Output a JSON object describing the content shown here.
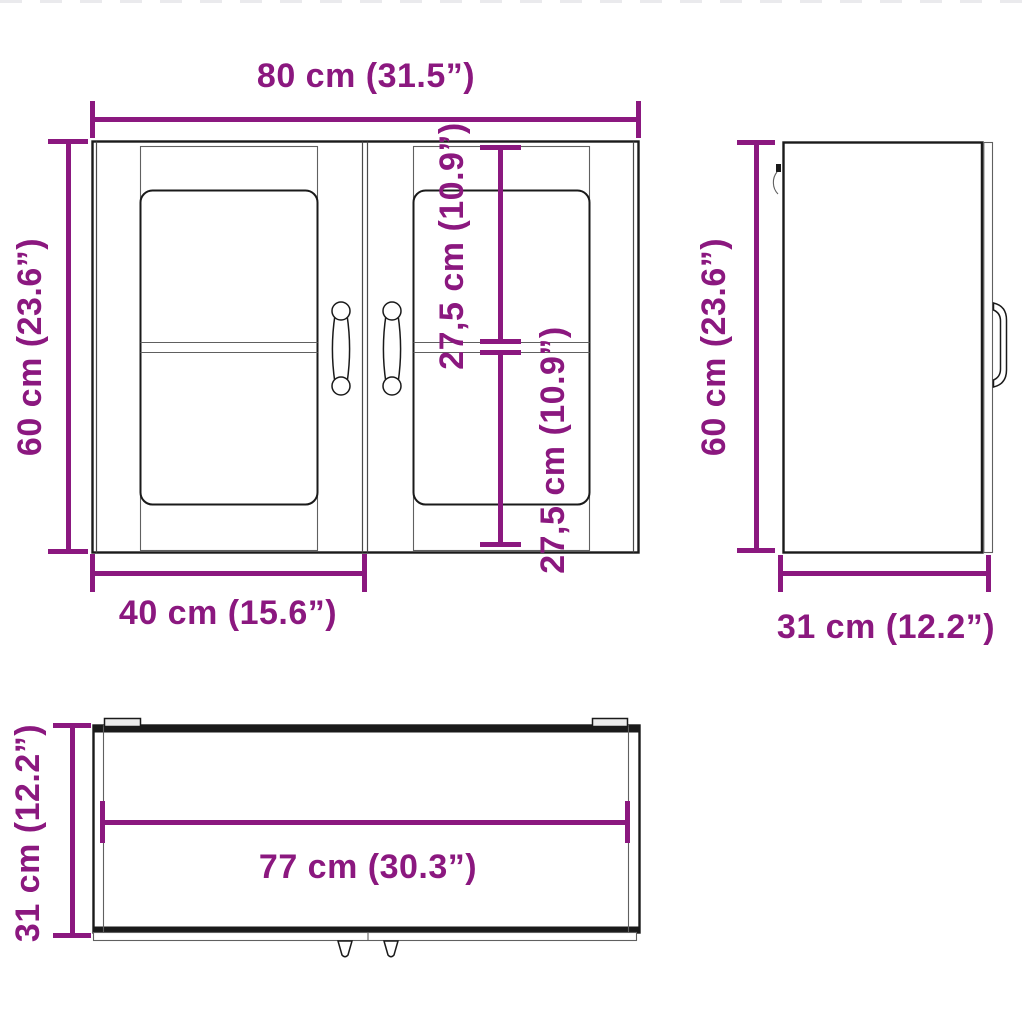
{
  "image_type": "wall cabinet dimension diagram",
  "accent_color": "#8B187F",
  "line_color": "#1a1a1a",
  "views": {
    "front": {
      "name": "front view",
      "overall_width": "80 cm (31.5”)",
      "overall_height": "60 cm (23.6”)",
      "door_width": "40 cm (15.6”)",
      "upper_compartment_height": "27,5 cm (10.9”)",
      "lower_compartment_height": "27,5 cm (10.9”)"
    },
    "side": {
      "name": "side view",
      "overall_height": "60 cm (23.6”)",
      "depth": "31 cm (12.2”)"
    },
    "top": {
      "name": "top view",
      "depth": "31 cm (12.2”)",
      "inner_width": "77 cm (30.3”)"
    }
  }
}
